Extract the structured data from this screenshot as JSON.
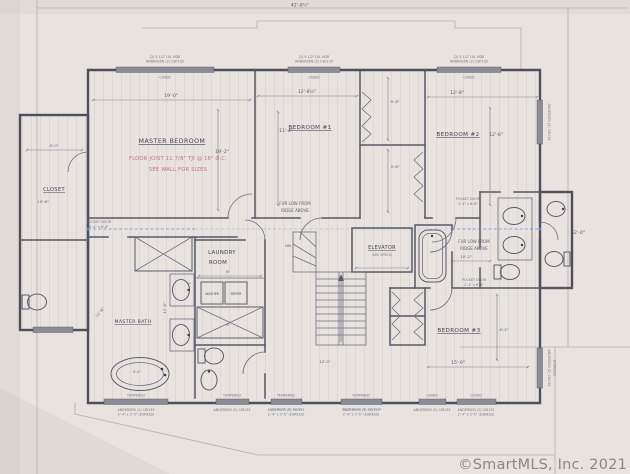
{
  "watermark": "©SmartMLS, Inc. 2021",
  "dims": {
    "overall_width": "42'-0½\"",
    "overall_height": "52'-0\"",
    "master_w": "19'-0\"",
    "master_h": "19'-2\"",
    "bed1_w": "12'-8½\"",
    "bed1_h": "11'-4\"",
    "bed2_w": "12'-8\"",
    "bed2_h": "12'-6\"",
    "bed3_w": "15'-0\"",
    "bed3_h": "6'-2\"",
    "closet_w": "8'-0\"",
    "closet_h": "19'-6\"",
    "closet1_d": "9'-6\"",
    "closet2_d": "9'-6\"",
    "bath_w": "10'-2\"",
    "mbath_a": "11'-6\"",
    "mbath_b": "12'-6\"",
    "laundry_a": "7'",
    "laundry_b": "6'",
    "laundry_c": "6'",
    "hall": "12'-0\"",
    "tub": "6'-0\""
  },
  "rooms": {
    "master": "MASTER BEDROOM",
    "bed1": "BEDROOM #1",
    "bed2": "BEDROOM #2",
    "bed3": "BEDROOM #3",
    "laundry1": "LAUNDRY",
    "laundry2": "ROOM",
    "mbath": "MASTER BATH",
    "closet": "CLOSET",
    "elevator": "ELEVATOR",
    "elevator_sub": "(SEE SPECS)",
    "washer": "WASHER",
    "dryer": "DRYER",
    "stair": "DN"
  },
  "notes": {
    "joist1": "FLOOR JOIST 11 7/8\" TJI @ 16\" O.C.",
    "joist2": "SEE WALL FOR SIZES",
    "fur1": "FUR LOW FROM",
    "fur2": "RIDGE ABOVE",
    "pocket1": "POCKET DOOR",
    "pocket2": "2'-4\" x 6'-8\""
  },
  "windows": {
    "hdr1": "(2) 9 1/2\" LVL HDR",
    "hdr2": "ANDERSEN (2) CW-135",
    "cased": "CASED",
    "tempered": "TEMPERED",
    "sub1": "ANDERSEN (2) CW135",
    "sub2": "2'-4\" x 3'-5\" (EGRESS)",
    "egress": "(EGRESS)"
  },
  "colors": {
    "paper": "#e9e5e0",
    "wall": "#4d4f5b",
    "blue_line": "#5b8fd8",
    "red_note": "#c05f5f",
    "watermark_gray": "#7f7f84"
  }
}
